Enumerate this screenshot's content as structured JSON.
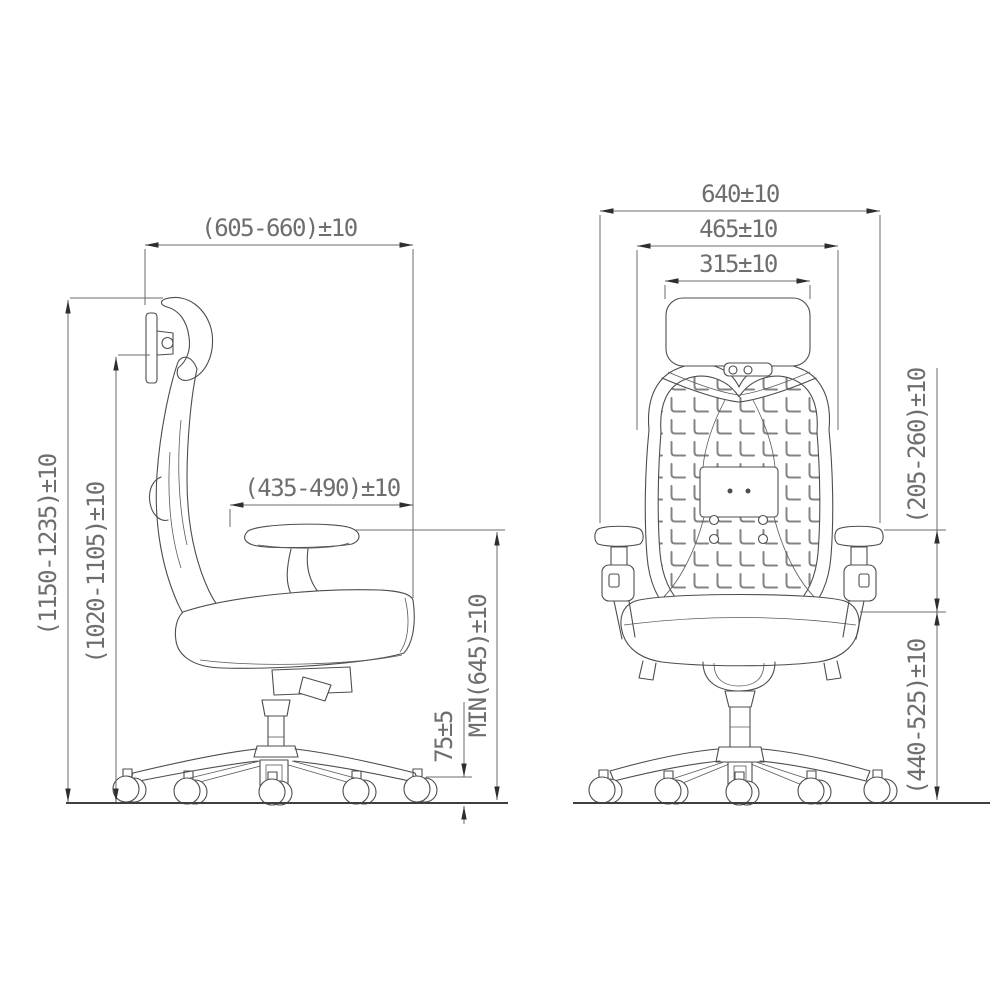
{
  "drawing": {
    "background": "#ffffff",
    "stroke_color": "#4d4d4d",
    "dimension_color": "#6e6e6e",
    "mesh_color": "#808080"
  },
  "side_view": {
    "dimensions": {
      "overall_depth": "(605-660)±10",
      "overall_height": "(1150-1235)±10",
      "backrest_height": "(1020-1105)±10",
      "seat_depth": "(435-490)±10",
      "armrest_height_min": "MIN(645)±10",
      "caster_height": "75±5"
    }
  },
  "rear_view": {
    "dimensions": {
      "overall_width": "640±10",
      "backrest_width": "465±10",
      "headrest_width": "315±10",
      "seat_to_armrest": "(205-260)±10",
      "seat_height": "(440-525)±10"
    }
  }
}
